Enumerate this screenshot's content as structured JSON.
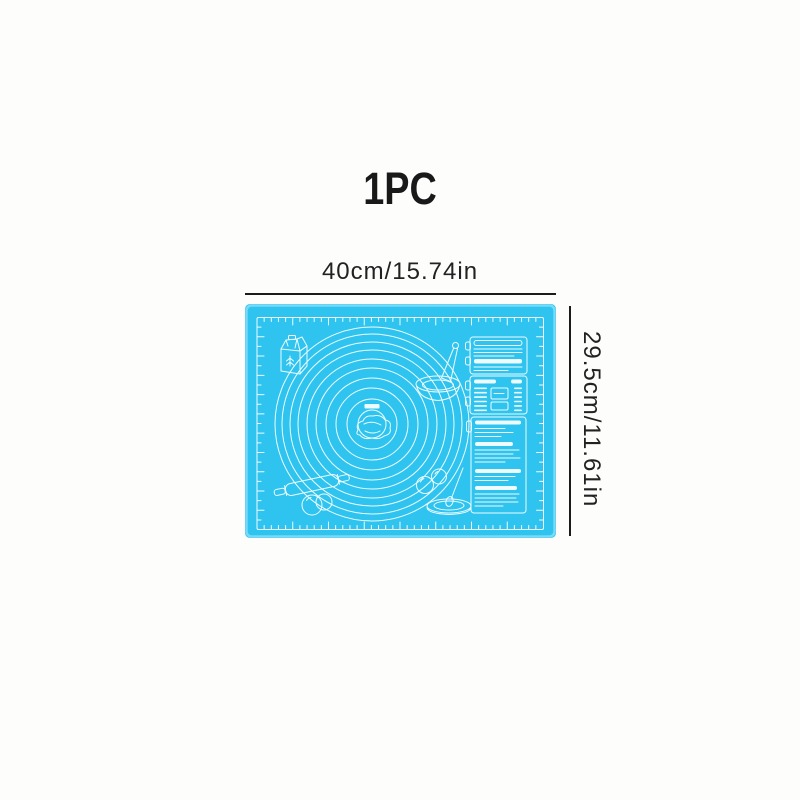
{
  "title": "1PC",
  "dimension_labels": {
    "width": "40cm/15.74in",
    "height": "29.5cm/11.61in"
  },
  "colors": {
    "background": "#FDFDFC",
    "mat": "#2EC4EF",
    "mat_edge": "#8BE0F8",
    "mat_lines": "#EFFCFF",
    "text": "#222222"
  },
  "mat_icons": [
    "flour-bag-icon",
    "mixing-bowl-spoon-icon",
    "concentric-measuring-circles",
    "center-dough-icon",
    "rolling-pin-icon",
    "dough-balls-icon",
    "eggs-icon",
    "pan-spoon-icon",
    "conversion-chart-top",
    "conversion-chart-middle",
    "conversion-chart-bottom"
  ]
}
